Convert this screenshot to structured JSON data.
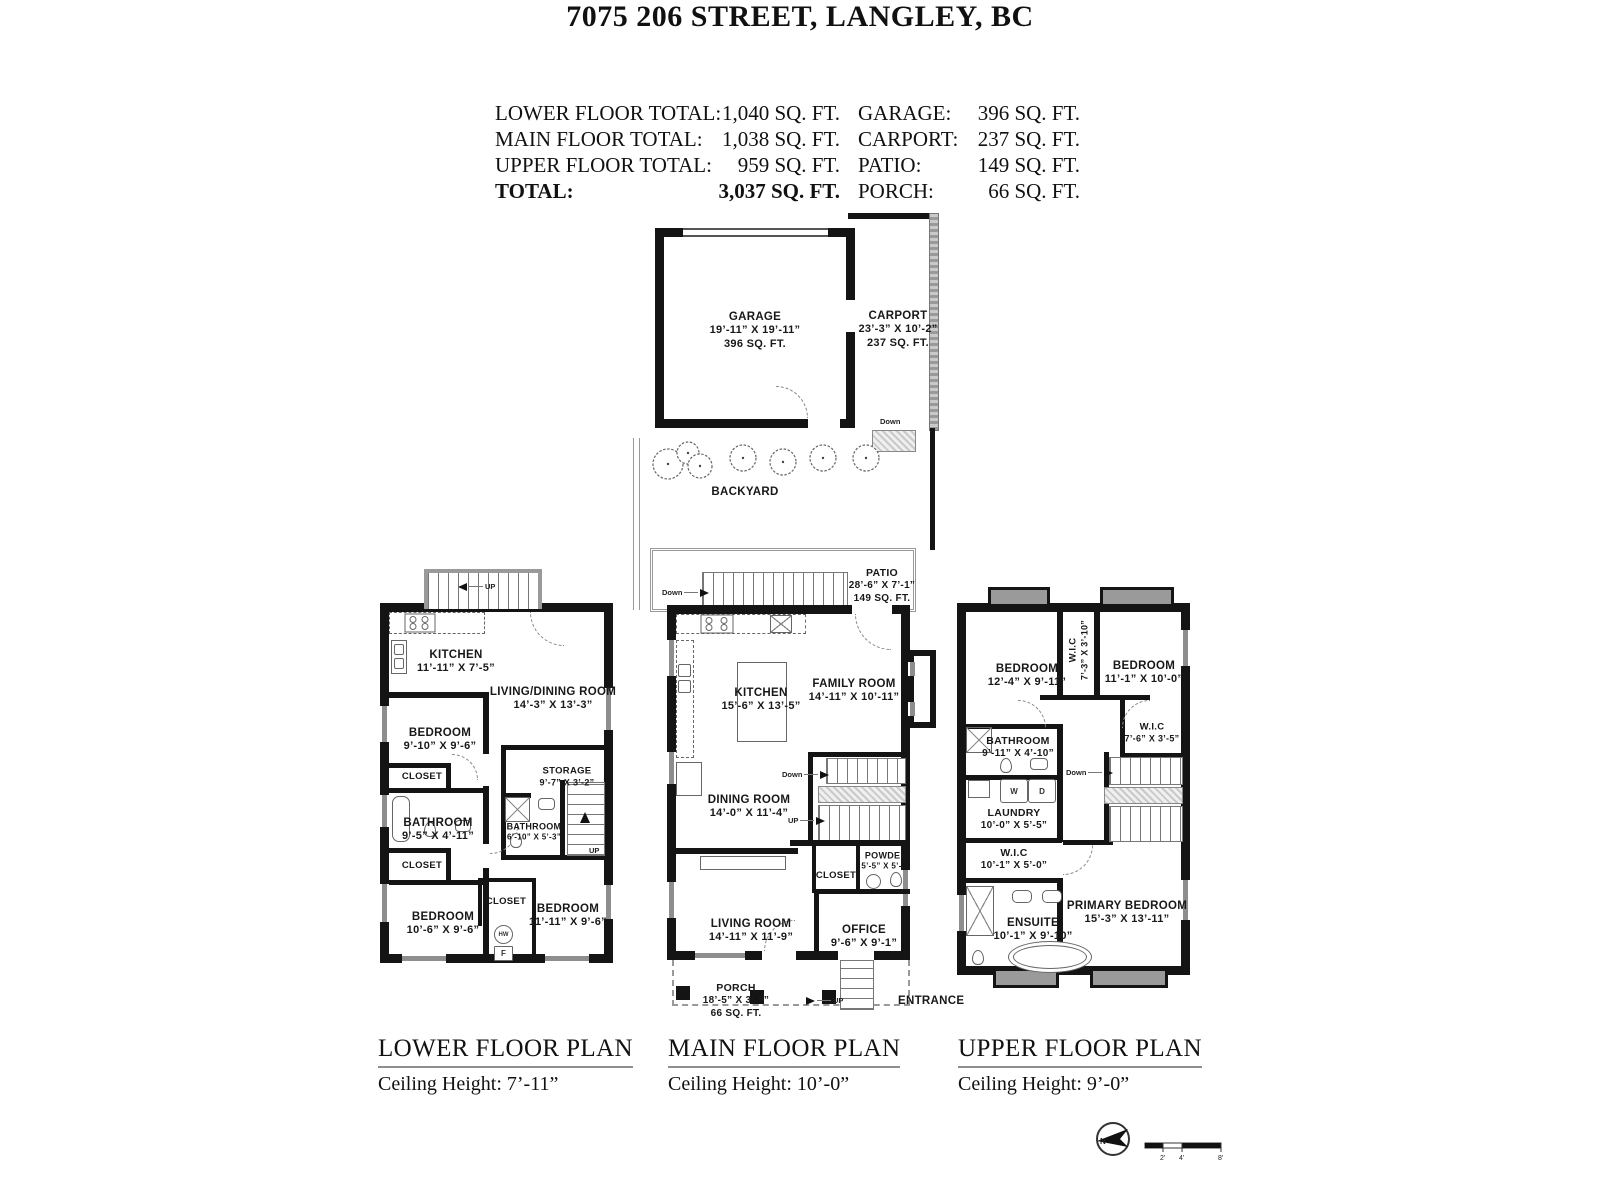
{
  "header": {
    "title": "7075 206 STREET, LANGLEY, BC",
    "summary_left": [
      {
        "label": "LOWER FLOOR TOTAL:",
        "value": "1,040 SQ. FT."
      },
      {
        "label": "MAIN FLOOR TOTAL:",
        "value": "1,038 SQ. FT."
      },
      {
        "label": "UPPER FLOOR TOTAL:",
        "value": "959 SQ. FT."
      },
      {
        "label": "TOTAL:",
        "value": "3,037 SQ. FT."
      }
    ],
    "summary_right": [
      {
        "label": "GARAGE:",
        "value": "396 SQ. FT."
      },
      {
        "label": "CARPORT:",
        "value": "237 SQ. FT."
      },
      {
        "label": "PATIO:",
        "value": "149 SQ. FT."
      },
      {
        "label": "PORCH:",
        "value": "66 SQ. FT."
      }
    ]
  },
  "labels": {
    "up": "UP",
    "down": "Down",
    "closet": "CLOSET",
    "entrance": "ENTRANCE"
  },
  "fixtures": {
    "hw": "HW",
    "f": "F",
    "w": "W",
    "d": "D"
  },
  "site": {
    "garage": {
      "name": "GARAGE",
      "dims": "19’-11” X 19’-11”",
      "area": "396 SQ. FT."
    },
    "carport": {
      "name": "CARPORT",
      "dims": "23’-3” X 10’-2”",
      "area": "237 SQ. FT."
    },
    "backyard": {
      "name": "BACKYARD"
    },
    "patio": {
      "name": "PATIO",
      "dims": "28’-6” X 7’-1”",
      "area": "149 SQ. FT."
    }
  },
  "lower": {
    "rooms": {
      "kitchen": {
        "name": "KITCHEN",
        "dims": "11’-11” X 7’-5”"
      },
      "living_dining": {
        "name": "LIVING/DINING ROOM",
        "dims": "14’-3” X 13’-3”"
      },
      "bedroom1": {
        "name": "BEDROOM",
        "dims": "9’-10” X 9’-6”"
      },
      "bathroom1": {
        "name": "BATHROOM",
        "dims": "9’-5” X 4’-11”"
      },
      "storage": {
        "name": "STORAGE",
        "dims": "9’-7” X 3’-2”"
      },
      "bathroom2": {
        "name": "BATHROOM",
        "dims": "6’-10” X 5’-3”"
      },
      "bedroom2": {
        "name": "BEDROOM",
        "dims": "10’-6” X 9’-6”"
      },
      "bedroom3": {
        "name": "BEDROOM",
        "dims": "11’-11” X 9’-6”"
      }
    },
    "footer": {
      "title": "LOWER FLOOR PLAN",
      "ceiling": "Ceiling Height: 7’-11”"
    }
  },
  "main": {
    "rooms": {
      "kitchen": {
        "name": "KITCHEN",
        "dims": "15’-6” X 13’-5”"
      },
      "family": {
        "name": "FAMILY ROOM",
        "dims": "14’-11” X 10’-11”"
      },
      "dining": {
        "name": "DINING ROOM",
        "dims": "14’-0” X 11’-4”"
      },
      "living": {
        "name": "LIVING ROOM",
        "dims": "14’-11” X 11’-9”"
      },
      "office": {
        "name": "OFFICE",
        "dims": "9’-6” X 9’-1”"
      },
      "powder": {
        "name": "POWDER",
        "dims": "5’-5” X 5’-2”"
      },
      "porch": {
        "name": "PORCH",
        "dims": "18’-5” X 3’-9”",
        "area": "66 SQ. FT."
      }
    },
    "footer": {
      "title": "MAIN FLOOR PLAN",
      "ceiling": "Ceiling Height: 10’-0”"
    }
  },
  "upper": {
    "rooms": {
      "bedroom1": {
        "name": "BEDROOM",
        "dims": "12’-4” X 9’-11”"
      },
      "wic1": {
        "name": "W.I.C",
        "dims": "7’-3” X 3’-10”"
      },
      "bedroom2": {
        "name": "BEDROOM",
        "dims": "11’-1” X 10’-0”"
      },
      "wic2": {
        "name": "W.I.C",
        "dims": "7’-6” X 3’-5”"
      },
      "bathroom": {
        "name": "BATHROOM",
        "dims": "9’-11” X 4’-10”"
      },
      "laundry": {
        "name": "LAUNDRY",
        "dims": "10’-0” X 5’-5”"
      },
      "wic3": {
        "name": "W.I.C",
        "dims": "10’-1” X 5’-0”"
      },
      "ensuite": {
        "name": "ENSUITE",
        "dims": "10’-1” X 9’-10”"
      },
      "primary": {
        "name": "PRIMARY BEDROOM",
        "dims": "15’-3” X 13’-11”"
      }
    },
    "footer": {
      "title": "UPPER FLOOR PLAN",
      "ceiling": "Ceiling Height: 9’-0”"
    }
  },
  "legend": {
    "compass_n": "N",
    "scale_ticks": [
      "2’",
      "4’",
      "8’"
    ]
  }
}
